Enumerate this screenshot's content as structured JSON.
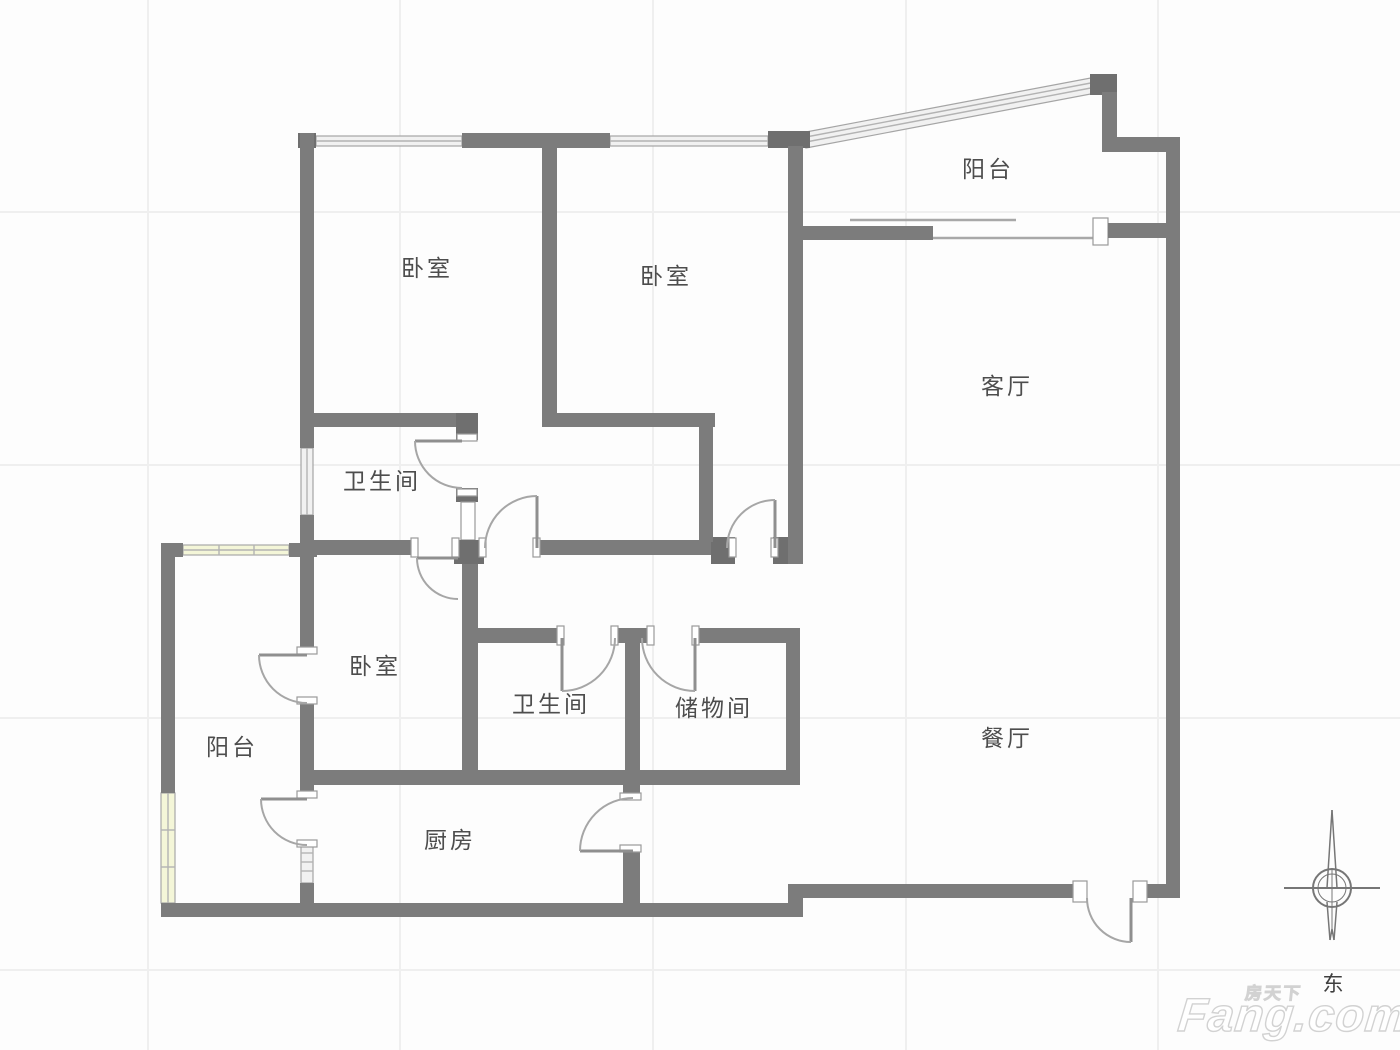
{
  "page": {
    "type": "floor-plan"
  },
  "rooms": [
    {
      "key": "bedroom-1",
      "label": "卧室",
      "x": 427,
      "y": 276
    },
    {
      "key": "bedroom-2",
      "label": "卧室",
      "x": 666,
      "y": 284
    },
    {
      "key": "balcony-top",
      "label": "阳台",
      "x": 988,
      "y": 177
    },
    {
      "key": "living-room",
      "label": "客厅",
      "x": 1007,
      "y": 394
    },
    {
      "key": "bathroom-1",
      "label": "卫生间",
      "x": 382,
      "y": 489
    },
    {
      "key": "bedroom-3",
      "label": "卧室",
      "x": 375,
      "y": 674
    },
    {
      "key": "balcony-left",
      "label": "阳台",
      "x": 232,
      "y": 755
    },
    {
      "key": "bathroom-2",
      "label": "卫生间",
      "x": 551,
      "y": 712
    },
    {
      "key": "storage",
      "label": "储物间",
      "x": 714,
      "y": 716
    },
    {
      "key": "dining-room",
      "label": "餐厅",
      "x": 1007,
      "y": 746
    },
    {
      "key": "kitchen",
      "label": "厨房",
      "x": 450,
      "y": 848
    }
  ],
  "compass": {
    "label": "东"
  },
  "watermark": {
    "brand_cn": "房天下",
    "brand_en": "Fang.com"
  },
  "colors": {
    "background": "#fdfdfd",
    "wall": "#7c7c7c",
    "window": "#f1f1f1",
    "window_tinted": "#f4f6d8",
    "door": "#a6a6a6",
    "text": "#4d4d4d",
    "grid": "#efefef",
    "watermark": "#ffffff"
  }
}
